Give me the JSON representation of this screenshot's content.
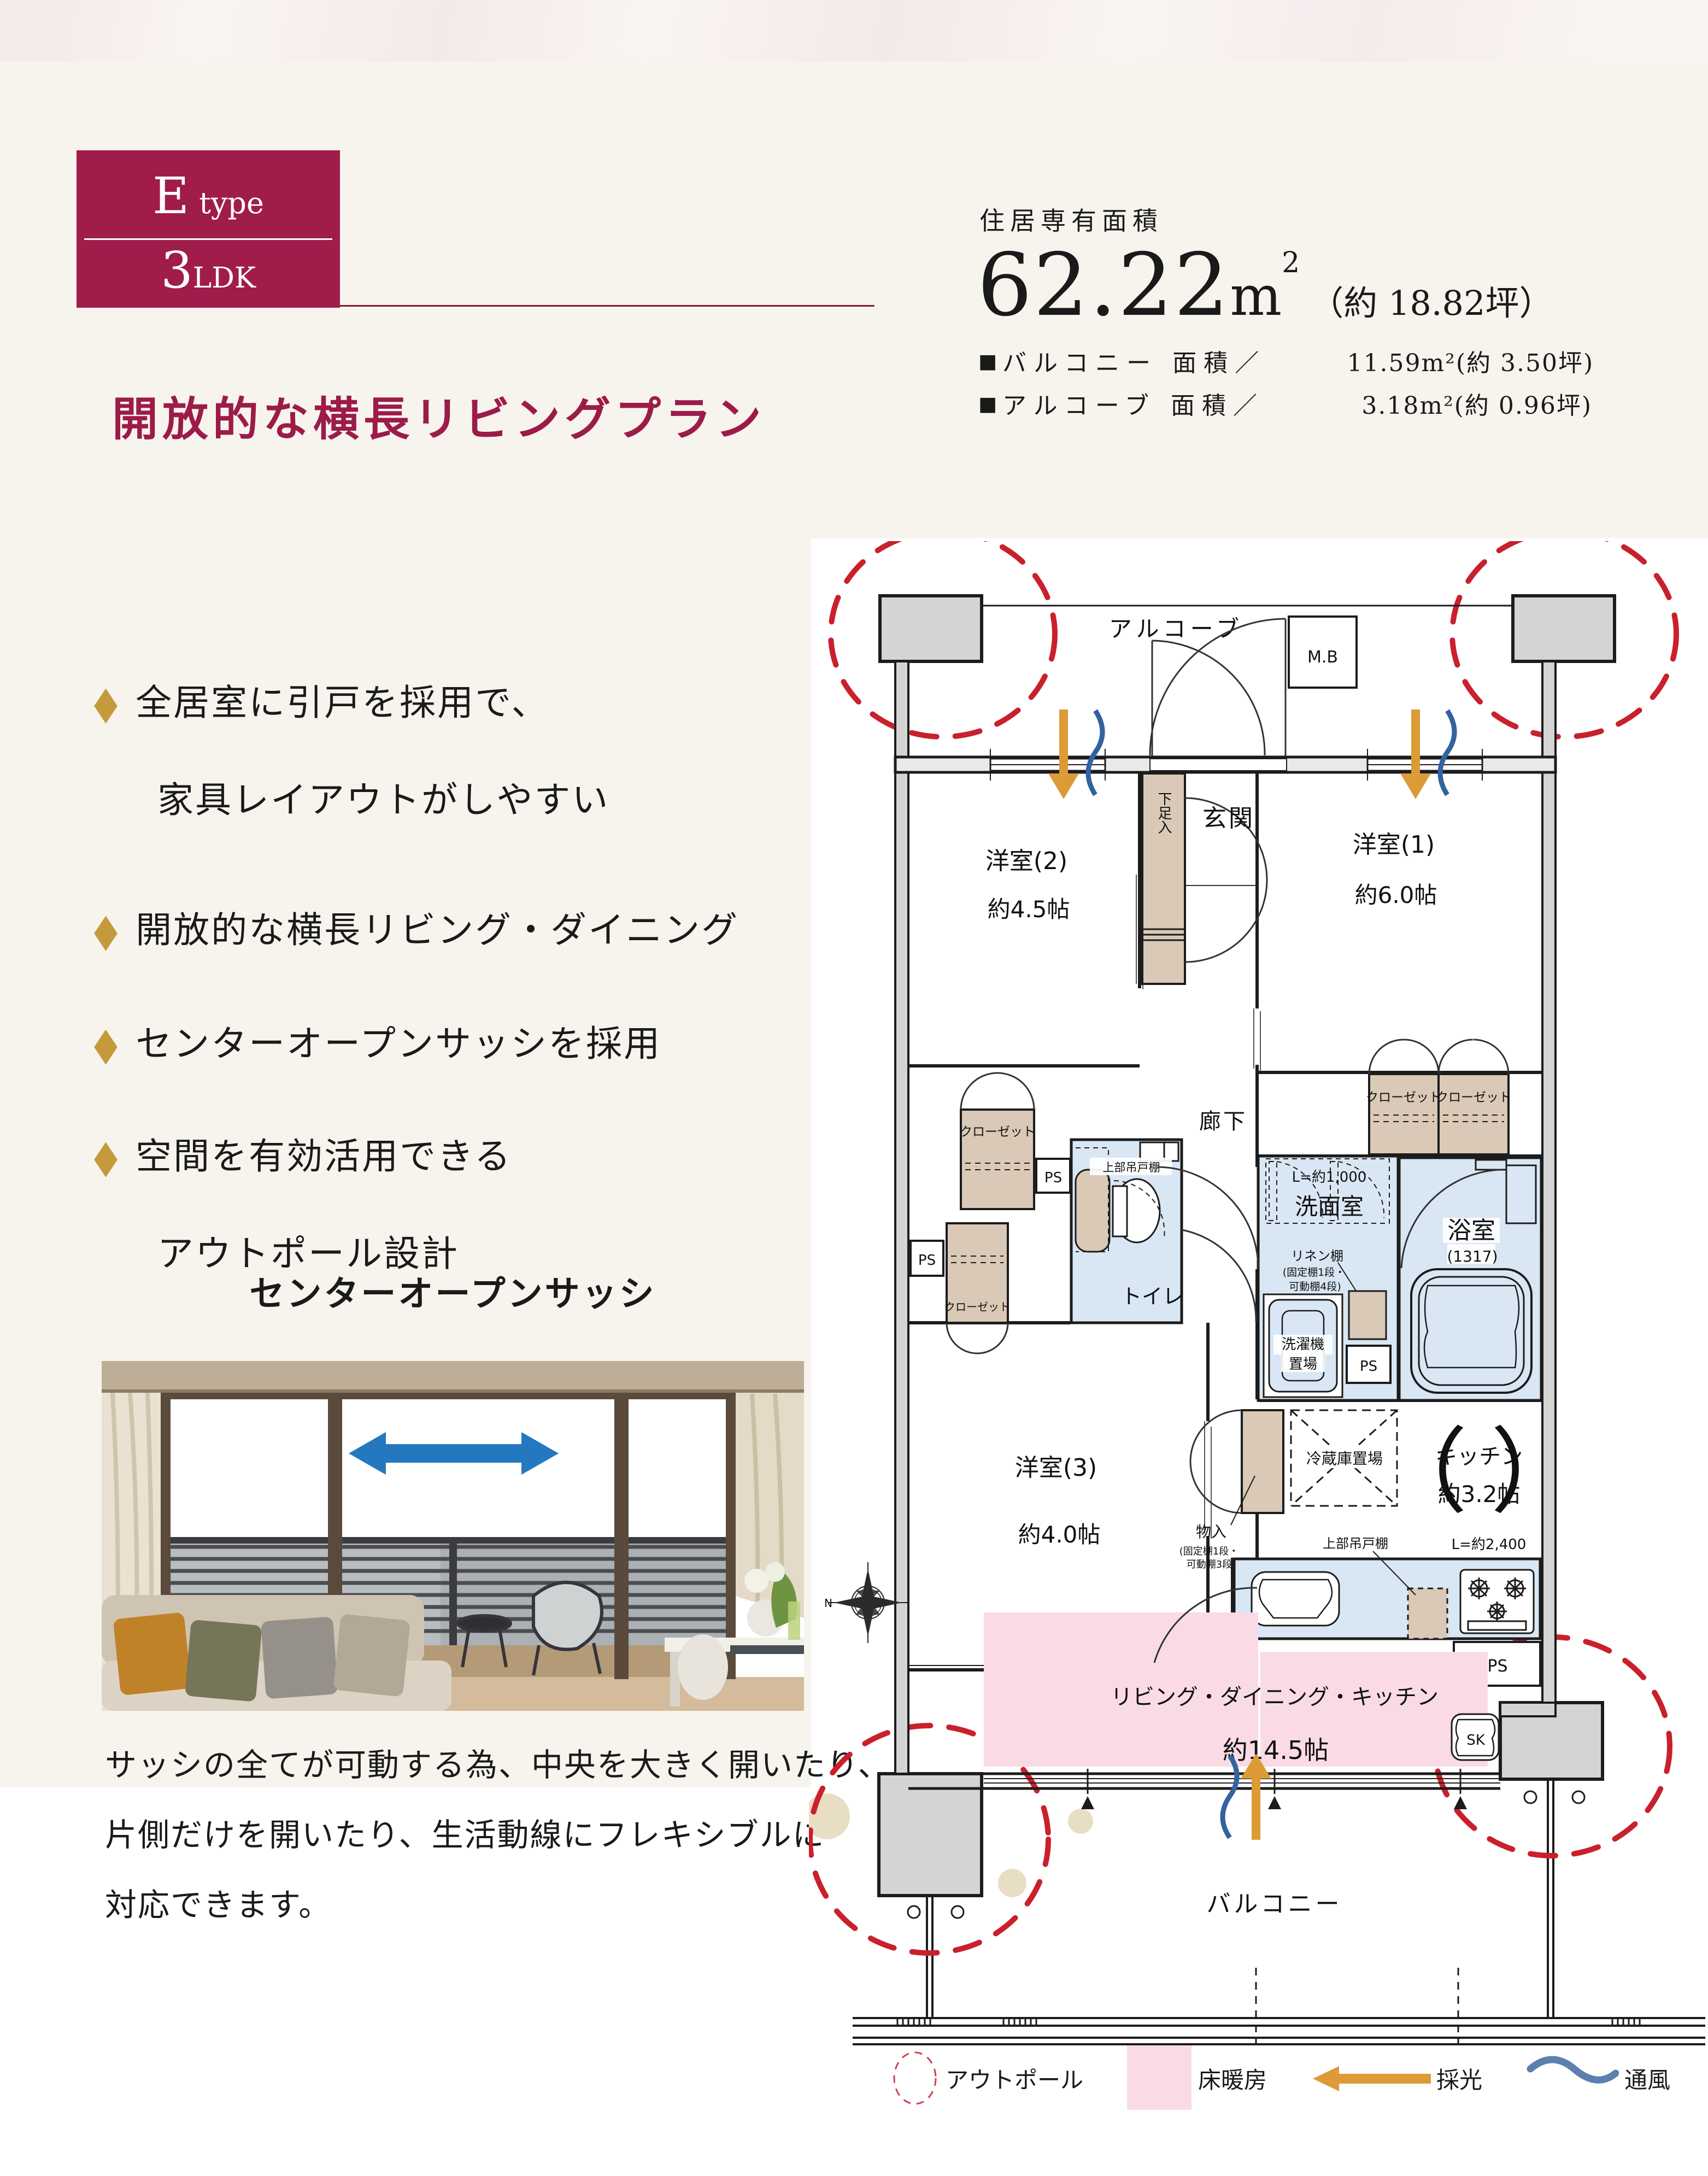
{
  "ui": {
    "diamond": "◆",
    "square": "■"
  },
  "badge": {
    "letter": "E",
    "word": "type",
    "num": "3",
    "ldk": "LDK"
  },
  "header": {
    "label": "住居専有面積",
    "value": "62.22",
    "unit": "m",
    "unit_sup": "2",
    "tsubo": "（約 18.82坪）",
    "items": [
      {
        "name": "バルコニー 面積／",
        "value": "11.59m²(約  3.50坪)"
      },
      {
        "name": "アルコーブ 面積／",
        "value": "3.18m²(約  0.96坪)"
      }
    ]
  },
  "title": "開放的な横長リビングプラン",
  "features": [
    {
      "line1": "全居室に引戸を採用で、",
      "line2": "家具レイアウトがしやすい"
    },
    {
      "line1": "開放的な横長リビング・ダイニング",
      "line2": ""
    },
    {
      "line1": "センターオープンサッシを採用",
      "line2": ""
    },
    {
      "line1": "空間を有効活用できる",
      "line2": "アウトポール設計"
    }
  ],
  "sash": {
    "heading": "センターオープンサッシ",
    "caption1": "サッシの全てが可動する為、中央を大きく開いたり、",
    "caption2": "片側だけを開いたり、生活動線にフレキシブルに",
    "caption3": "対応できます。"
  },
  "plan": {
    "alcove": "アルコーブ",
    "mb": "M.B",
    "genkan": "玄関",
    "shoe": "下足入",
    "r2": "洋室(2)",
    "r2_size": "約4.5帖",
    "r1": "洋室(1)",
    "r1_size": "約6.0帖",
    "hall": "廊下",
    "closet": "クローゼット",
    "ps": "PS",
    "upper_cabinet": "上部吊戸棚",
    "toilet": "トイレ",
    "wash_l": "L=約1,000",
    "wash": "洗面室",
    "linen1": "リネン棚",
    "linen2": "(固定棚1段・",
    "linen3": "可動棚4段)",
    "washer1": "洗濯機",
    "washer2": "置場",
    "bath": "浴室",
    "bath_size": "(1317)",
    "r3": "洋室(3)",
    "r3_size": "約4.0帖",
    "mono1": "物入",
    "mono2": "(固定棚1段・",
    "mono3": "可動棚3段)",
    "fridge": "冷蔵庫置場",
    "paren_open": "（",
    "paren_close": "）",
    "kitchen": "キッチン",
    "kitchen_size": "約3.2帖",
    "kitchen_l": "L=約2,400",
    "counter": "カウンター",
    "ldk": "リビング・ダイニング・キッチン",
    "ldk_size": "約14.5帖",
    "balcony": "バルコニー",
    "sk": "SK",
    "north": "N"
  },
  "legend": {
    "outpole": "アウトポール",
    "heating": "床暖房",
    "light": "採光",
    "wind": "通風"
  },
  "colors": {
    "crimson": "#a01c4b",
    "gold": "#c49a3d",
    "wet_blue": "#d9e7f4",
    "closet_beige": "#d9c9b6",
    "heating_pink": "#fadbe5",
    "outpole_red": "#c9202c",
    "light_orange": "#dc9b37",
    "wind_blue": "#33639f",
    "photo_arrow_blue": "#2478bf"
  }
}
